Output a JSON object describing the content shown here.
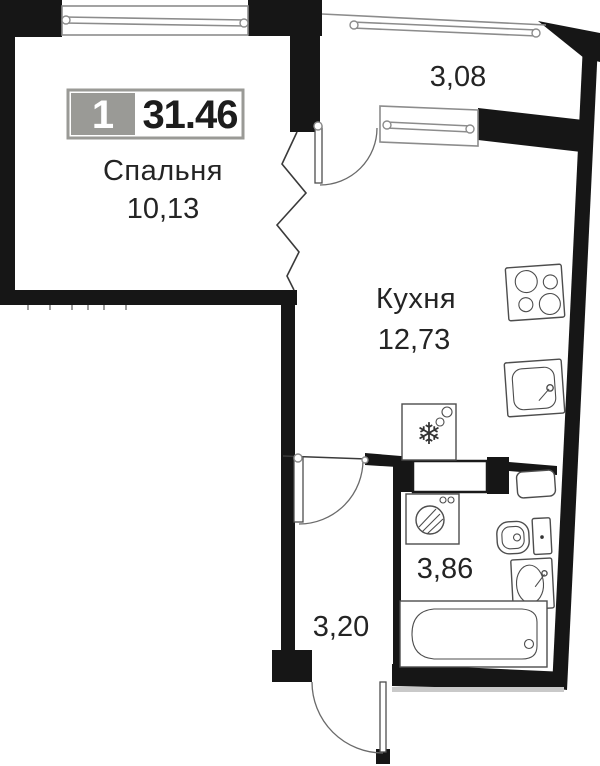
{
  "plan": {
    "title": "apartment-floor-plan",
    "badge": {
      "unit_number": "1",
      "total_area": "31.46"
    },
    "rooms": [
      {
        "id": "bedroom",
        "label": "Спальня",
        "area": "10,13"
      },
      {
        "id": "balcony",
        "label": "",
        "area": "3,08"
      },
      {
        "id": "kitchen",
        "label": "Кухня",
        "area": "12,73"
      },
      {
        "id": "bathroom",
        "label": "",
        "area": "3,86"
      },
      {
        "id": "hallway",
        "label": "",
        "area": "3,20"
      }
    ],
    "fixtures": [
      "bedroom-window",
      "balcony-glazing",
      "balcony-kitchen-window",
      "balcony-door",
      "interior-door",
      "bathroom-door",
      "entrance-door",
      "stove-hob",
      "kitchen-sink",
      "fridge",
      "washing-machine",
      "water-heater",
      "toilet",
      "bathroom-sink",
      "bathtub"
    ],
    "symbols": {
      "fridge_snowflake": "❄"
    },
    "colors": {
      "wall": "#161616",
      "badge_gray": "#9a9a96",
      "text": "#242424",
      "background": "#ffffff"
    }
  }
}
